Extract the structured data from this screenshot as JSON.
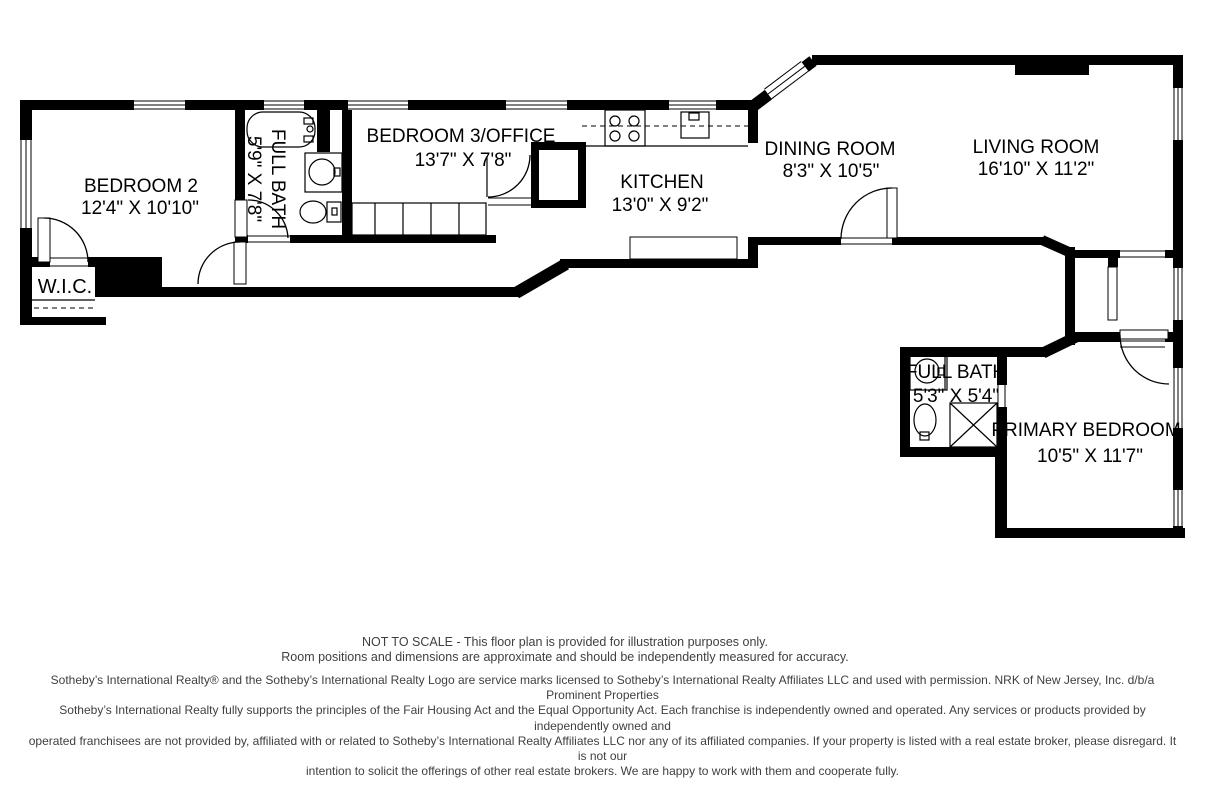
{
  "floorplan": {
    "wall_color": "#000000",
    "label_color": "#000000",
    "rooms": {
      "bedroom2": {
        "name": "BEDROOM 2",
        "dims": "12'4\" X 10'10\""
      },
      "bath1": {
        "name": "FULL BATH",
        "dims": "5'9\" X 7'8\""
      },
      "bedroom3": {
        "name": "BEDROOM 3/OFFICE",
        "dims": "13'7\" X 7'8\""
      },
      "kitchen": {
        "name": "KITCHEN",
        "dims": "13'0\" X 9'2\""
      },
      "dining": {
        "name": "DINING ROOM",
        "dims": "8'3\" X 10'5\""
      },
      "living": {
        "name": "LIVING ROOM",
        "dims": "16'10\" X 11'2\""
      },
      "wic": {
        "name": "W.I.C."
      },
      "bath2": {
        "name": "FULL BATH",
        "dims": "5'3\" X 5'4\""
      },
      "primary": {
        "name": "PRIMARY BEDROOM",
        "dims": "10'5\" X 11'7\""
      }
    }
  },
  "footer": {
    "text_color": "#3f3f3f",
    "notice_lines": [
      "NOT TO SCALE - This floor plan is provided for illustration purposes only.",
      "Room positions and dimensions are approximate and should be independently measured for accuracy."
    ],
    "legal_lines": [
      "Sotheby’s International Realty® and the Sotheby’s International Realty Logo are service marks licensed to Sotheby’s International Realty Affiliates LLC and used with permission. NRK of New Jersey, Inc. d/b/a Prominent Properties",
      "Sotheby’s International Realty fully supports the principles of the Fair Housing Act and the Equal Opportunity Act. Each franchise is independently owned and operated. Any services or products provided by independently owned and",
      "operated franchisees are not provided by, affiliated with or related to Sotheby’s International Realty Affiliates LLC nor any of its affiliated companies. If your property is listed with a real estate broker, please disregard. It is not our",
      "intention to solicit the offerings of other real estate brokers. We are happy to work with them and cooperate fully."
    ]
  }
}
